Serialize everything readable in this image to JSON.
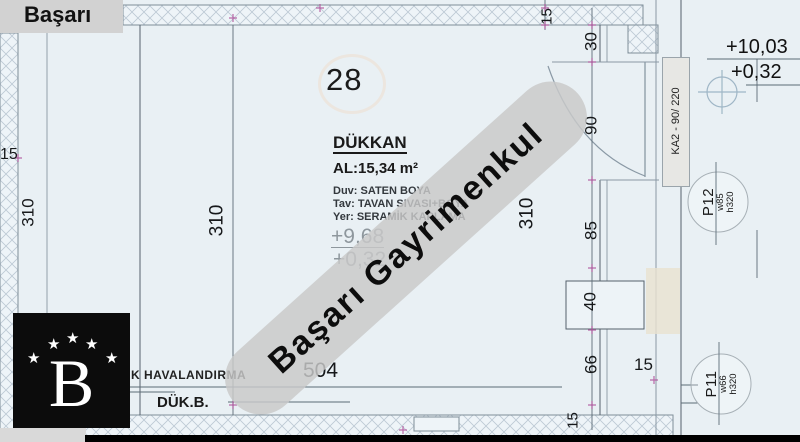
{
  "brand": "Başarı",
  "watermark": "Başarı Gayrimenkul",
  "logo": {
    "letter": "B",
    "stars": [
      "★",
      "★",
      "★",
      "★",
      "★"
    ]
  },
  "room": {
    "number": "28",
    "name": "DÜKKAN",
    "area": "AL:15,34 m²",
    "spec_duv": "Duv: SATEN BOYA",
    "spec_tav": "Tav: TAVAN SIVASI+BOYA",
    "spec_yer": "Yer: SERAMİK KAPLAMA",
    "elev_upper": "+9,68",
    "elev_lower": "+0,32"
  },
  "annotations": {
    "ventilation": "K HAVALANDIRMA",
    "duk_b": "DÜK.B.",
    "door_tag": "KA2 - 90/ 220",
    "elev_right_upper": "+10,03",
    "elev_right_lower": "+0,32"
  },
  "windows": {
    "p12": {
      "id": "P12",
      "w": "w85",
      "h": "h320"
    },
    "p11": {
      "id": "P11",
      "w": "w66",
      "h": "h320"
    }
  },
  "dims": {
    "width_504": "504",
    "h_310_left_wall": "310",
    "h_310_mid": "310",
    "h_310_right": "310",
    "left_wall_15": "15",
    "top_wall_15": "15",
    "right_30": "30",
    "right_90": "90",
    "right_85": "85",
    "right_40": "40",
    "right_66": "66",
    "corridor_15": "15",
    "bottom_wall_15": "15"
  },
  "colors": {
    "plan_background": "#e9f0f4",
    "wall_line": "#55616b",
    "hatch": "#bcc9d4",
    "cad_marker_magenta": "#b0529c",
    "watermark_band": "#c9c9c9",
    "logo_background": "#0c0c0c"
  }
}
